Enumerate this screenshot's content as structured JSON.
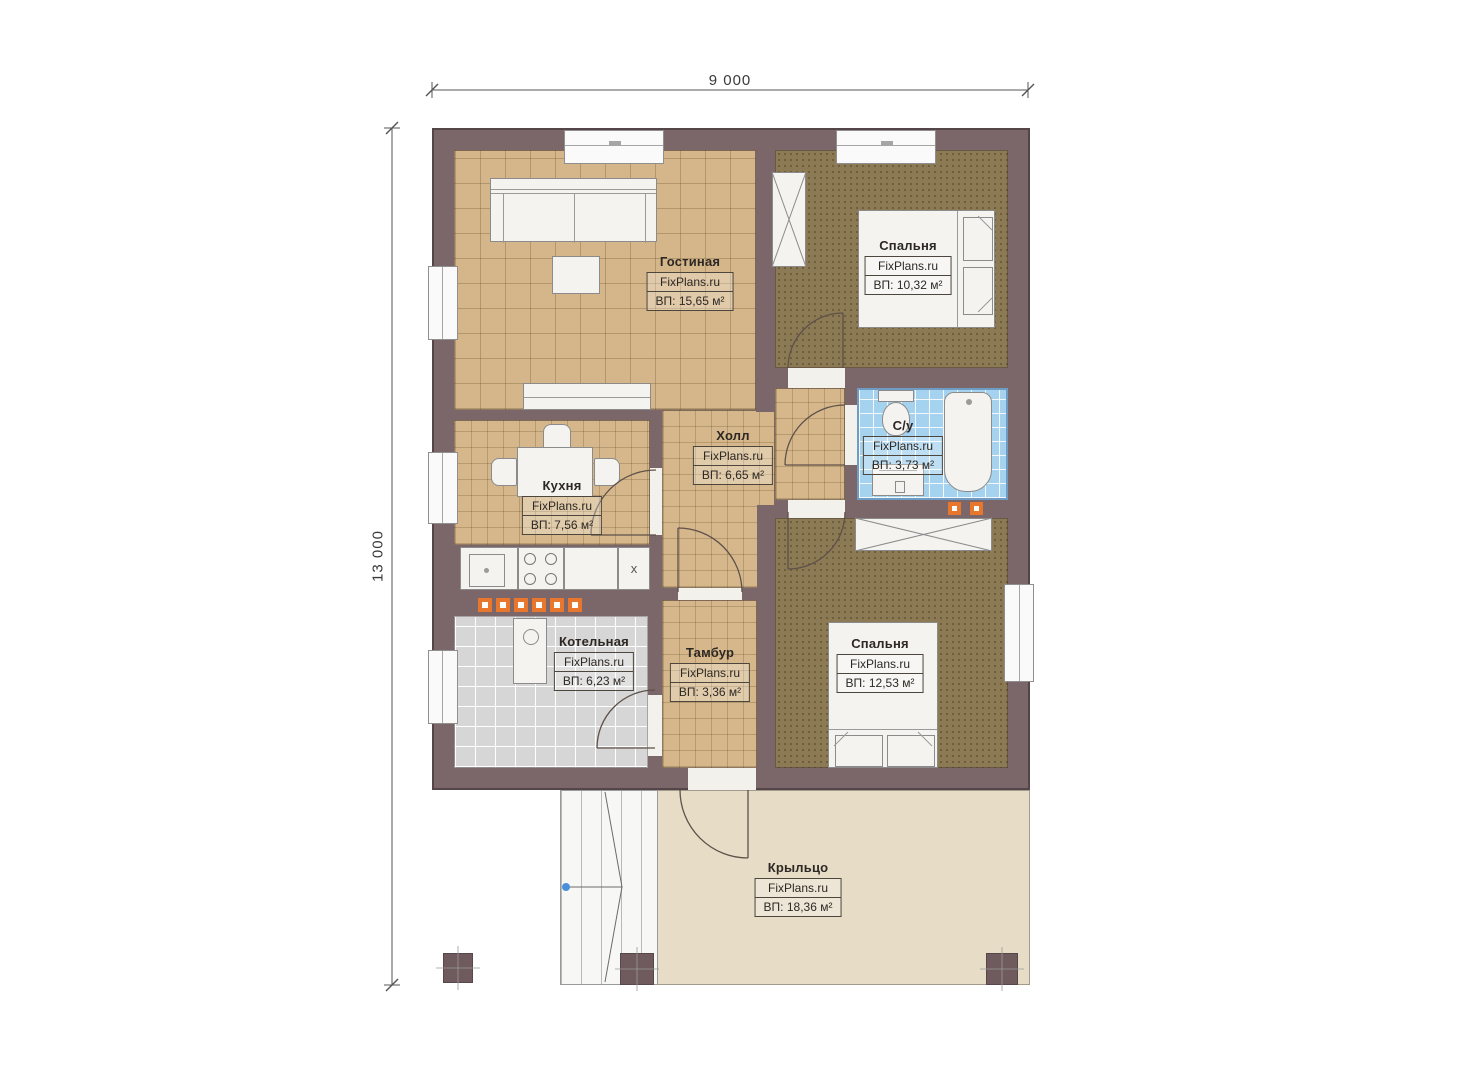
{
  "dimensions": {
    "width_mm": "9 000",
    "depth_mm": "13 000"
  },
  "rooms": [
    {
      "key": "living",
      "name": "Гостиная",
      "brand": "FixPlans.ru",
      "area": "ВП: 15,65 м²"
    },
    {
      "key": "bedroom-top",
      "name": "Спальня",
      "brand": "FixPlans.ru",
      "area": "ВП: 10,32 м²"
    },
    {
      "key": "kitchen",
      "name": "Кухня",
      "brand": "FixPlans.ru",
      "area": "ВП: 7,56 м²"
    },
    {
      "key": "hall",
      "name": "Холл",
      "brand": "FixPlans.ru",
      "area": "ВП: 6,65 м²"
    },
    {
      "key": "bathroom",
      "name": "С/у",
      "brand": "FixPlans.ru",
      "area": "ВП: 3,73 м²"
    },
    {
      "key": "boiler",
      "name": "Котельная",
      "brand": "FixPlans.ru",
      "area": "ВП: 6,23 м²"
    },
    {
      "key": "tambour",
      "name": "Тамбур",
      "brand": "FixPlans.ru",
      "area": "ВП: 3,36 м²"
    },
    {
      "key": "bedroom-bottom",
      "name": "Спальня",
      "brand": "FixPlans.ru",
      "area": "ВП: 12,53 м²"
    },
    {
      "key": "porch",
      "name": "Крыльцо",
      "brand": "FixPlans.ru",
      "area": "ВП: 18,36 м²"
    }
  ],
  "appliances": {
    "fridge_mark": "x"
  },
  "palette": {
    "wall": "#7b666a",
    "wood_floor": "#d4b68a",
    "bedroom_floor": "#8c7a54",
    "bathroom_tile": "#a5d2ef",
    "boiler_tile": "#d6d6d6",
    "porch_floor": "#e7ddc7",
    "accent_orange": "#e8762c",
    "marker_blue": "#4a90d9"
  }
}
